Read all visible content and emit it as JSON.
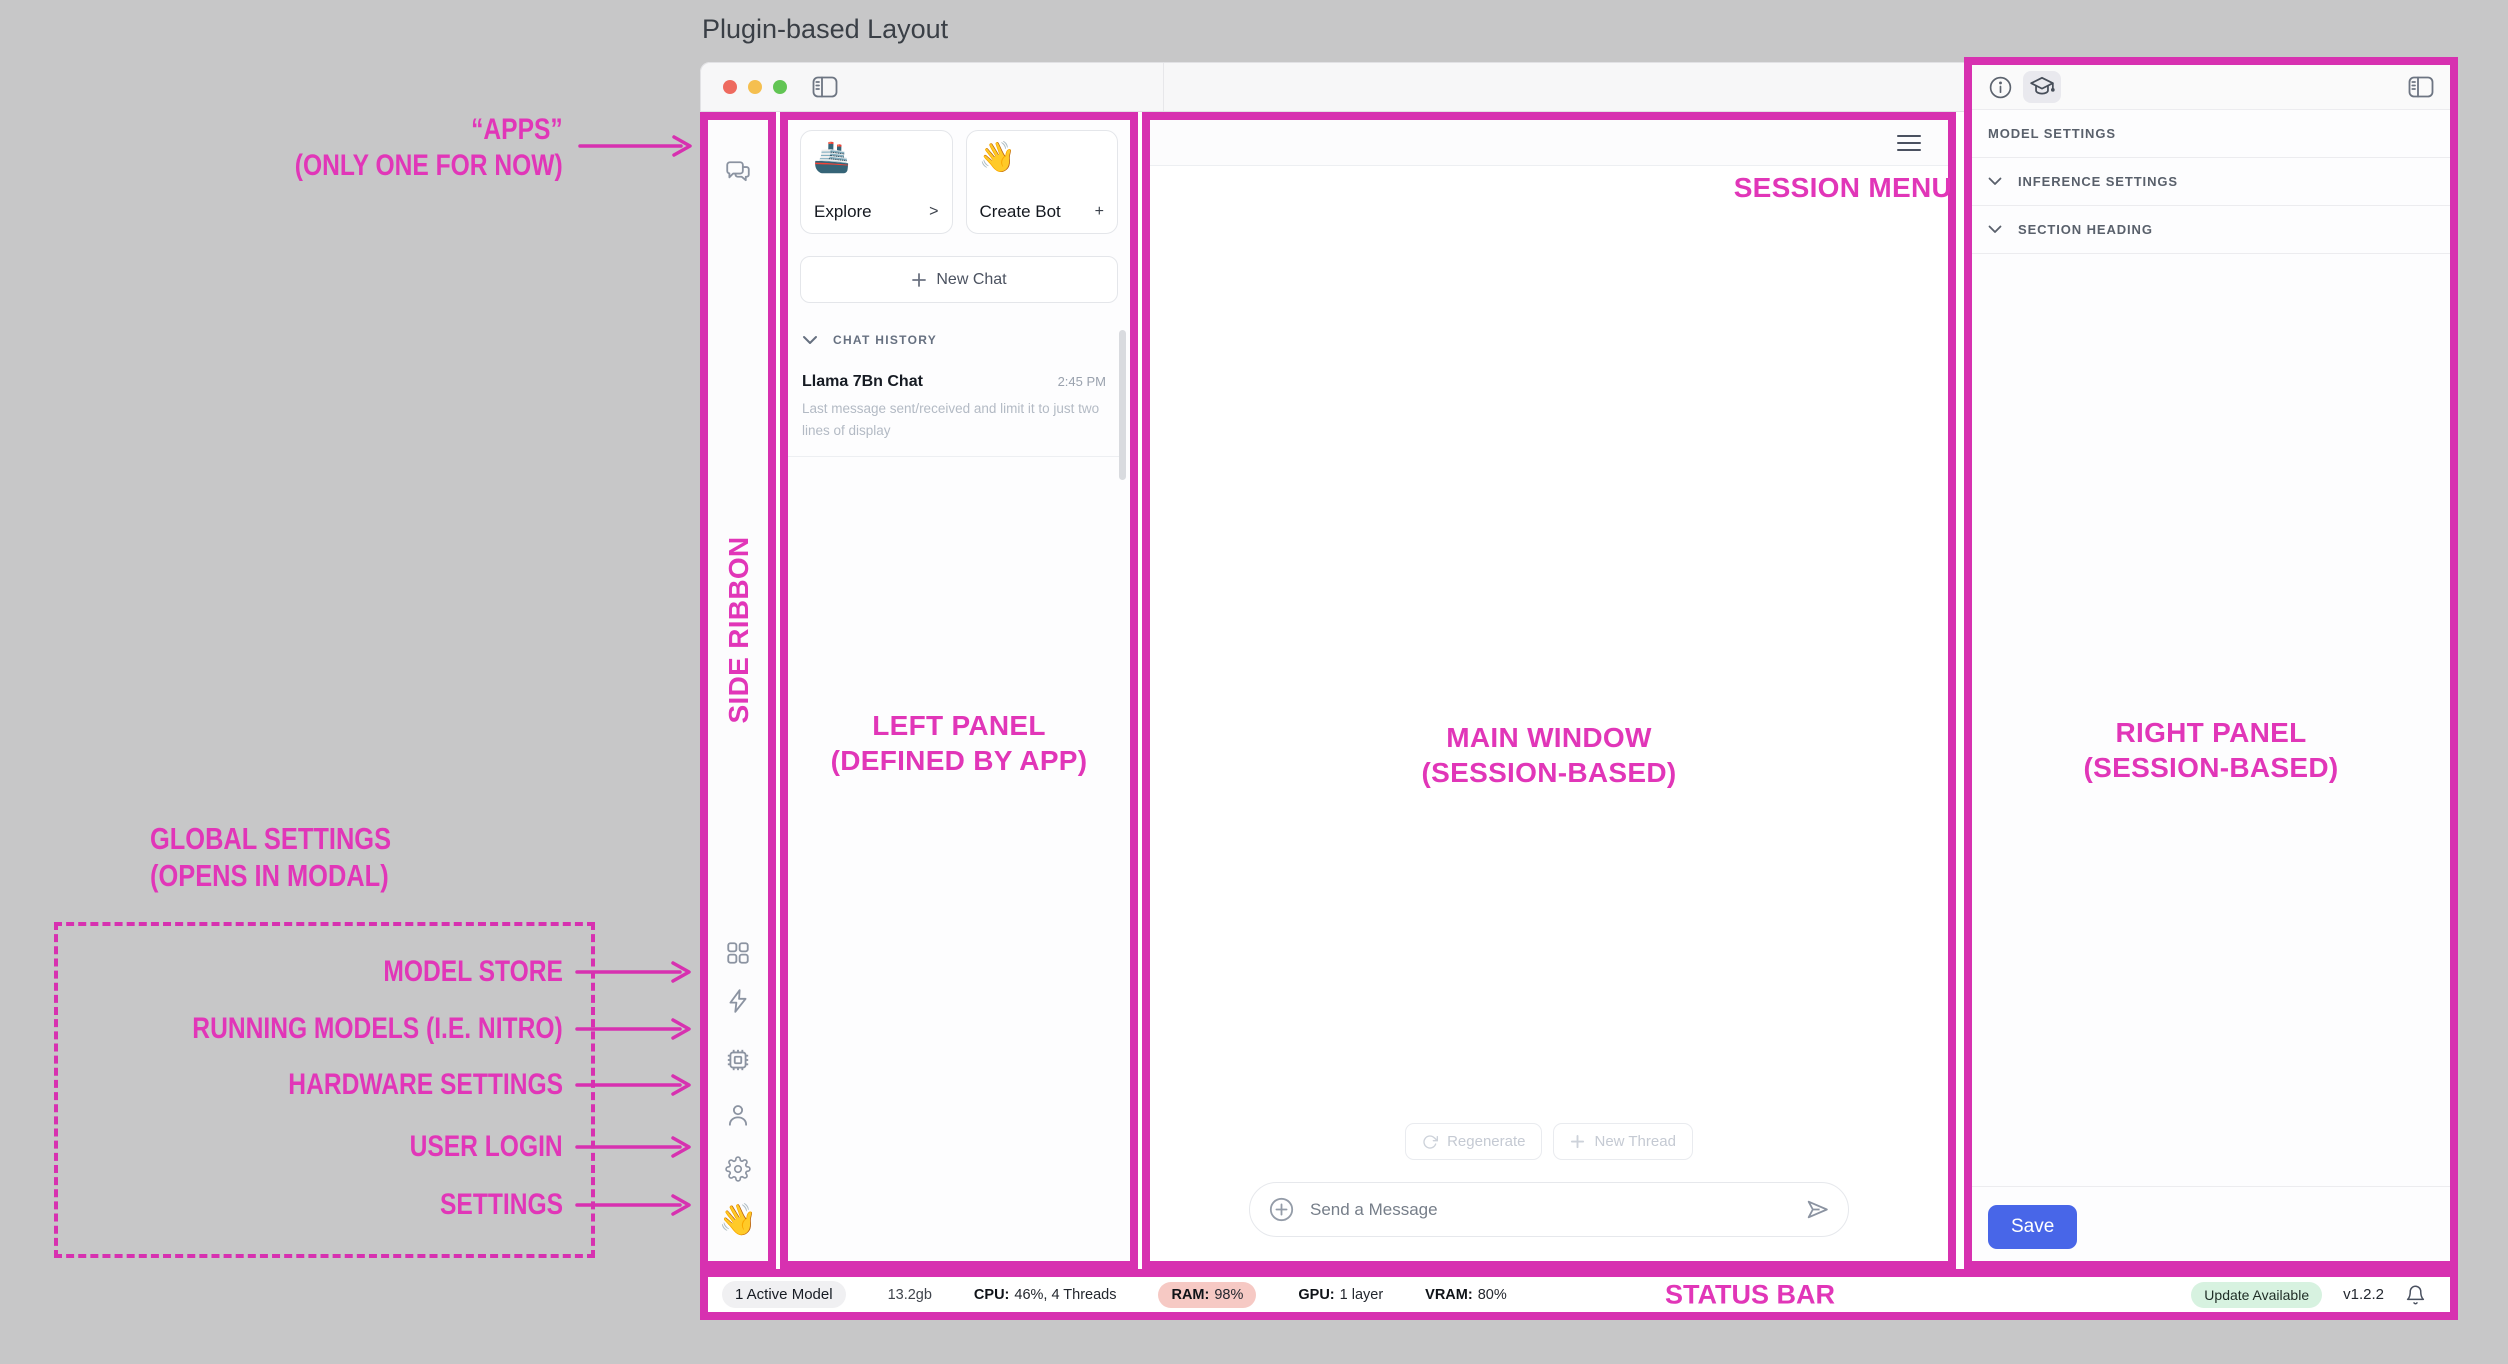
{
  "window": {
    "page_title": "Plugin-based Layout"
  },
  "annotations": {
    "accent_color": "#d731b0",
    "apps": {
      "line1": "“APPS”",
      "line2": "(ONLY ONE FOR NOW)"
    },
    "global_settings": {
      "line1": "GLOBAL SETTINGS",
      "line2": "(OPENS IN MODAL)"
    },
    "model_store": "MODEL STORE",
    "running_models": "RUNNING MODELS (I.E. NITRO)",
    "hardware_settings": "HARDWARE SETTINGS",
    "user_login": "USER LOGIN",
    "settings": "SETTINGS",
    "side_ribbon": "SIDE RIBBON",
    "left_panel": {
      "line1": "LEFT PANEL",
      "line2": "(DEFINED BY APP)"
    },
    "main_window": {
      "line1": "MAIN WINDOW",
      "line2": "(SESSION-BASED)"
    },
    "right_panel": {
      "line1": "RIGHT PANEL",
      "line2": "(SESSION-BASED)"
    },
    "session_menu": "SESSION MENU",
    "status_bar": "STATUS BAR"
  },
  "left_panel": {
    "cards": [
      {
        "emoji": "🚢",
        "label": "Explore",
        "trailing": ">"
      },
      {
        "emoji": "👋",
        "label": "Create Bot",
        "trailing": "+"
      }
    ],
    "new_chat_label": "New Chat",
    "chat_history_header": "CHAT HISTORY",
    "chat_items": [
      {
        "title": "Llama 7Bn Chat",
        "time": "2:45 PM",
        "preview": "Last message sent/received and limit it to just two lines of display"
      }
    ]
  },
  "main_window": {
    "regenerate_label": "Regenerate",
    "new_thread_label": "New Thread",
    "message_placeholder": "Send a Message"
  },
  "right_panel": {
    "section_title": "MODEL SETTINGS",
    "rows": [
      {
        "label": "INFERENCE SETTINGS"
      },
      {
        "label": "SECTION HEADING"
      }
    ],
    "save_label": "Save",
    "save_color": "#4866e8"
  },
  "status_bar": {
    "active_model": "1 Active Model",
    "disk": "13.2gb",
    "cpu_label": "CPU:",
    "cpu_value": "46%, 4 Threads",
    "ram_label": "RAM:",
    "ram_value": "98%",
    "ram_pill_color": "#f6c9c4",
    "gpu_label": "GPU:",
    "gpu_value": "1 layer",
    "vram_label": "VRAM:",
    "vram_value": "80%",
    "update_badge": "Update Available",
    "update_badge_color": "#d7f2e0",
    "version": "v1.2.2",
    "ribbon_bottom_emoji": "👋"
  }
}
